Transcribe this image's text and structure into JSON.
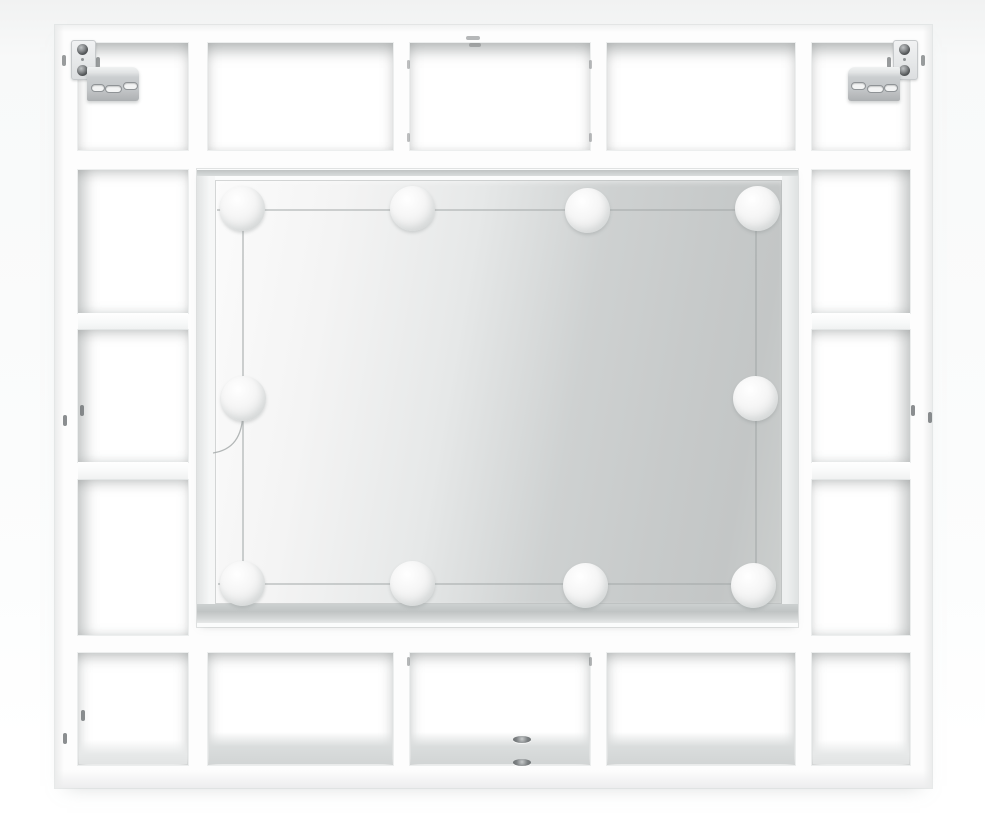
{
  "scene": {
    "description": "Front view product photo of a white wall-mounted dressing mirror cabinet with an LED bulb string around the mirror, framed on all sides by open cube shelving compartments; two metal wall-mount brackets at the top corners.",
    "colors": {
      "background": "#f1f2f2",
      "furniture": "#ffffff",
      "mirror_light_side": "#fbfbfb",
      "mirror_dark_side": "#c3c6c6",
      "mirror_sill": "#c0c4c4",
      "metal_bracket": "#c2c5c7",
      "led_bulb": "#f2f3f3",
      "wire": "#a3a8a8"
    }
  },
  "unit": {
    "top_row_compartments": 5,
    "bottom_row_compartments": 5,
    "left_column_compartments": 3,
    "right_column_compartments": 3,
    "wall_brackets": 2
  },
  "leds": {
    "count": 10,
    "bulb_diameter_px": 45,
    "positions": [
      [
        242,
        208
      ],
      [
        412,
        208
      ],
      [
        587,
        210
      ],
      [
        757,
        208
      ],
      [
        243,
        398
      ],
      [
        755,
        398
      ],
      [
        242,
        583
      ],
      [
        412,
        583
      ],
      [
        585,
        585
      ],
      [
        753,
        585
      ]
    ]
  },
  "pin_holes": [
    {
      "x": 63,
      "y": 415,
      "w": 4,
      "h": 11,
      "o": 0.8
    },
    {
      "x": 80,
      "y": 405,
      "w": 4,
      "h": 11,
      "o": 0.8
    },
    {
      "x": 911,
      "y": 405,
      "w": 4,
      "h": 11,
      "o": 0.8
    },
    {
      "x": 928,
      "y": 412,
      "w": 4,
      "h": 11,
      "o": 0.8
    },
    {
      "x": 81,
      "y": 710,
      "w": 4,
      "h": 11,
      "o": 0.8
    },
    {
      "x": 63,
      "y": 733,
      "w": 4,
      "h": 11,
      "o": 0.8
    },
    {
      "x": 407,
      "y": 60,
      "w": 3,
      "h": 9,
      "o": 0.45
    },
    {
      "x": 589,
      "y": 60,
      "w": 3,
      "h": 9,
      "o": 0.45
    },
    {
      "x": 407,
      "y": 133,
      "w": 3,
      "h": 9,
      "o": 0.45
    },
    {
      "x": 589,
      "y": 133,
      "w": 3,
      "h": 9,
      "o": 0.45
    },
    {
      "x": 407,
      "y": 657,
      "w": 3,
      "h": 9,
      "o": 0.5
    },
    {
      "x": 589,
      "y": 657,
      "w": 3,
      "h": 9,
      "o": 0.5
    },
    {
      "x": 466,
      "y": 36,
      "w": 14,
      "h": 4,
      "o": 0.5
    },
    {
      "x": 469,
      "y": 43,
      "w": 12,
      "h": 4,
      "o": 0.45
    }
  ],
  "floor_holes": [
    {
      "x": 513,
      "y": 736,
      "w": 18,
      "h": 7
    },
    {
      "x": 513,
      "y": 759,
      "w": 18,
      "h": 7
    }
  ]
}
